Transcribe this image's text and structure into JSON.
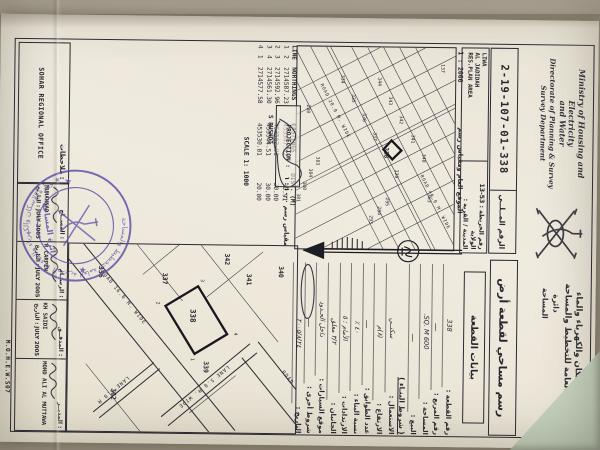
{
  "colors": {
    "ink": "#2a2a33",
    "paper": "#ece7db",
    "photo_background": "#aba394",
    "stamp_purple": "#5b4fa5",
    "green_sheet": "#c9d6c2"
  },
  "header": {
    "ministry_script_line1": "Ministry of Housing and Electricity",
    "ministry_script_line2": "and Water",
    "ministry_script_line3": "Directorate of Planning & Survey",
    "ministry_script_line4": "Survey Department",
    "ministry_arabic_line1": "وزارة الإسكان والكهرباء والماء",
    "ministry_arabic_line2": "المديرية العامة للتخطيط والمساحة",
    "ministry_arabic_line3": "دائرة المساحة",
    "emblem": "oman-national-emblem"
  },
  "ref_box": {
    "label_ar": "الرقم المــلــي",
    "value": "2-19-107-01-338"
  },
  "area_box": {
    "map_no_line": "رقم الخريطة : 53-13  الولاية",
    "town_label": "المدينة / القرية :",
    "area_en_line1": "LIWA",
    "area_en_line2": "AL JADIDAH",
    "area_en_line3": "RES.PLAN AREA"
  },
  "location_plan": {
    "scale_text": "1 : 2000",
    "caption_ar": "الموقع العام ومقياس رسم",
    "road_label_1": "ROAD 46.0 M. WIDE",
    "road_label_2": "ROAD 20.0 M. WIDE",
    "plots": [
      {
        "n": "137",
        "x": 16,
        "y": 14
      },
      {
        "n": "363",
        "x": 146,
        "y": 26
      },
      {
        "n": "344",
        "x": 30,
        "y": 77
      },
      {
        "n": "343",
        "x": 49,
        "y": 66
      },
      {
        "n": "342",
        "x": 68,
        "y": 55
      },
      {
        "n": "341",
        "x": 87,
        "y": 43
      },
      {
        "n": "340",
        "x": 106,
        "y": 32
      },
      {
        "n": "334",
        "x": 28,
        "y": 114
      },
      {
        "n": "335",
        "x": 47,
        "y": 103
      },
      {
        "n": "336",
        "x": 66,
        "y": 92
      },
      {
        "n": "337",
        "x": 85,
        "y": 81
      },
      {
        "n": "338",
        "x": 100,
        "y": 70,
        "b": 1
      },
      {
        "n": "339",
        "x": 122,
        "y": 59
      },
      {
        "n": "295",
        "x": 150,
        "y": 68
      },
      {
        "n": "294",
        "x": 159,
        "y": 76
      },
      {
        "n": "293",
        "x": 168,
        "y": 84
      },
      {
        "n": "280",
        "x": 58,
        "y": 148
      },
      {
        "n": "303",
        "x": 110,
        "y": 138
      },
      {
        "n": "304",
        "x": 122,
        "y": 145
      },
      {
        "n": "300",
        "x": 135,
        "y": 151
      },
      {
        "n": "301",
        "x": 147,
        "y": 157
      }
    ]
  },
  "coords_table": {
    "headers": {
      "line": "LINE",
      "northings": "NORTHINGS",
      "eastings": "EASTINGS",
      "dist": "DIST. (M)"
    },
    "rows": [
      [
        "1",
        "2",
        "2714587.23",
        "453547.52",
        "30.91"
      ],
      [
        "2",
        "3",
        "2714592.96",
        "453562.92",
        "20.00"
      ],
      [
        "3",
        "4",
        "2714561.30",
        "453544.51",
        "30.00"
      ],
      [
        "4",
        "1",
        "2714577.58",
        "453530.01",
        "20.00"
      ]
    ],
    "projection_label": "PROJECTION :",
    "annotation": "S RUSHDI",
    "scale_text": "SCALE 1: 1000"
  },
  "main_plan": {
    "scale_caption_ar": "مقياس رسم ١٠٠٠ : ١",
    "road_label_1": "ROAD 16.0 M. WIDE",
    "road_label_2": "LANE 5.0 M. WIDE",
    "road_label_3": "ROAD 10.0 M. WIDE",
    "road_label_4": "LANE 5.0 M",
    "plots": [
      {
        "n": "340",
        "x": 20,
        "y": 18
      },
      {
        "n": "341",
        "x": 28,
        "y": 50
      },
      {
        "n": "342",
        "x": 8,
        "y": 72
      },
      {
        "n": "337",
        "x": 28,
        "y": 134
      },
      {
        "n": "336",
        "x": 22,
        "y": 198
      },
      {
        "n": "339",
        "x": 116,
        "y": 92
      },
      {
        "n": "302",
        "x": 144,
        "y": 184
      },
      {
        "n": "338",
        "x": 64,
        "y": 106,
        "b": 1
      }
    ],
    "corners": [
      {
        "n": "4",
        "x": 87,
        "y": 62
      },
      {
        "n": "1",
        "x": 113,
        "y": 105
      },
      {
        "n": "2",
        "x": 57,
        "y": 140
      },
      {
        "n": "3",
        "x": 34,
        "y": 96
      }
    ]
  },
  "plot_data_panel": {
    "title_ar": "رسم مساحي لقطعة أرض",
    "subtitle_ar": "بيانات القطعة",
    "fields": [
      {
        "label": "رقم القطعة :",
        "value": "338"
      },
      {
        "label": "رقم المربع :",
        "value": "ــــ"
      },
      {
        "label": "المساحة :",
        "value": "600 SQ. M."
      },
      {
        "label": "البيع :",
        "value": "ــــ"
      },
      {
        "group": "( شروط البنـاء )"
      },
      {
        "label": "الاستعمال :",
        "value": "سكنــي"
      },
      {
        "label": "الارتفاع :",
        "value": "(٨)م"
      },
      {
        "label": "عدد الطوابق :",
        "value": "ــــ"
      },
      {
        "label": "نسبة البناء :",
        "value": "٤٠ ٪"
      },
      {
        "label": "الارتدادات :",
        "value": "الأمام : ٥"
      },
      {
        "label": "الجانبان :",
        "value": "٣/٢ معلق"
      },
      {
        "label": "موقع السيارات :",
        "value": "داخل الحـدود"
      },
      {
        "label": "شروط أخرى :",
        "value": "ــــ"
      },
      {
        "label": "التاريخ :",
        "value": "٢٠٠٥/٨/٢٤"
      }
    ]
  },
  "north_arrow": {
    "symbol": "north-direction"
  },
  "signature_block": {
    "cells": [
      {
        "role": "المســاح :",
        "name": "MUHANNAD",
        "date_label": "التاريخ :",
        "date": "JULY 2005"
      },
      {
        "role": "الرســام :",
        "name": "R CARPEN",
        "date_label": "التاريخ :",
        "date": "JULY 2005"
      },
      {
        "role": "المدقــق :",
        "name": "KH SAIDI",
        "date_label": "التاريخ :",
        "date": "JULY 2005"
      },
      {
        "role": "المديــر :",
        "name": "MOHD ALI AL MUTTAWA",
        "date_label": "",
        "date": ""
      }
    ]
  },
  "notes_box": {
    "label_ar": "ملاحظات :",
    "office": "SOHAR REGIONAL OFFICE"
  },
  "corner_code": "M.O.H.E.W.S07",
  "stamp": {
    "ring_text": "وزارة الإسكان والكهرباء والماء ★ المديرية العامة للتخطيط والمساحة ★",
    "center_text": "دائرة المساحة"
  }
}
